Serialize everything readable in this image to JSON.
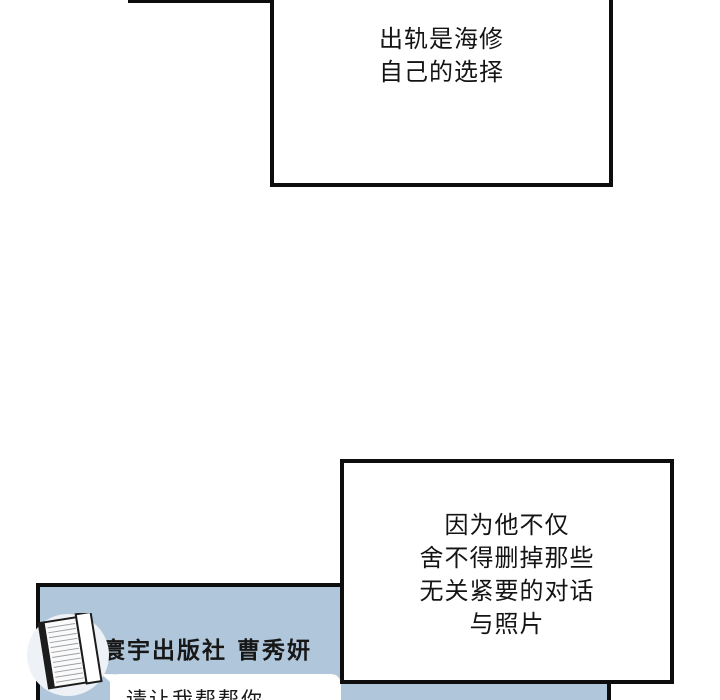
{
  "comic": {
    "speech_boxes": {
      "top": {
        "lines": [
          "出轨是海修",
          "自己的选择"
        ]
      },
      "bottom": {
        "lines": [
          "因为他不仅",
          "舍不得删掉那些",
          "无关紧要的对话",
          "与照片"
        ]
      }
    },
    "chat_panel": {
      "contact_name": "寰宇出版社 曹秀妍",
      "avatar_icon": "book-icon",
      "bubble_text": "请让我帮帮你"
    },
    "colors": {
      "page_background": "#ffffff",
      "panel_border": "#0d0d0d",
      "chat_panel_background": "#b0c6da",
      "speech_box_background": "#ffffff",
      "text": "#141414"
    }
  }
}
